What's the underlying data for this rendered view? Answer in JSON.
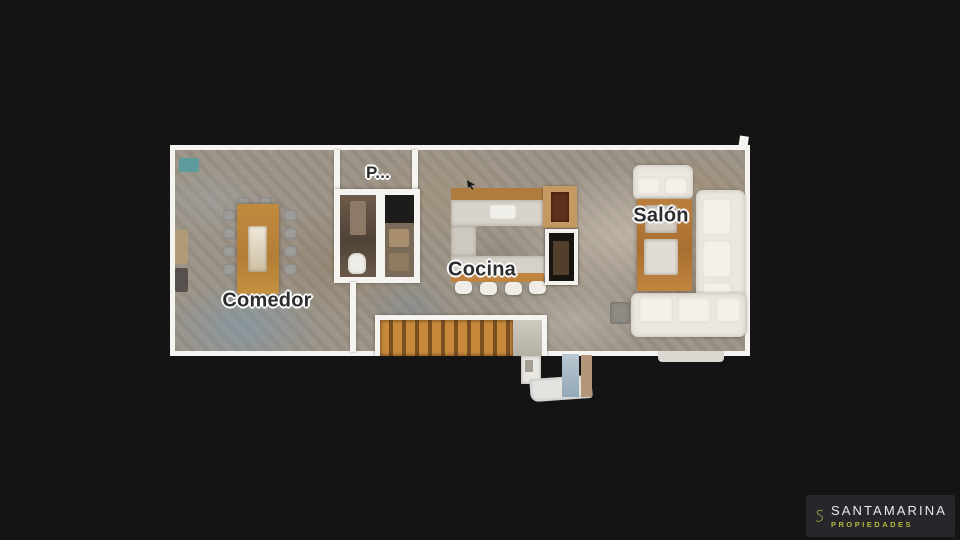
{
  "scene": {
    "view_type": "3d-dollhouse-floorplan",
    "background_color": "#141414",
    "wall_color": "#f6f4f0"
  },
  "floorplan": {
    "rooms": [
      {
        "id": "comedor",
        "label": "Comedor"
      },
      {
        "id": "p-room",
        "label": "P..."
      },
      {
        "id": "cocina",
        "label": "Cocina"
      },
      {
        "id": "salon",
        "label": "Salón"
      }
    ]
  },
  "branding": {
    "name": "SANTAMARINA",
    "tagline": "PROPIEDADES",
    "accent_color": "#b5b640",
    "text_color": "#eaeaea",
    "mark_icon": "s-monogram"
  },
  "icons": {
    "cursor": "arrow-cursor"
  }
}
